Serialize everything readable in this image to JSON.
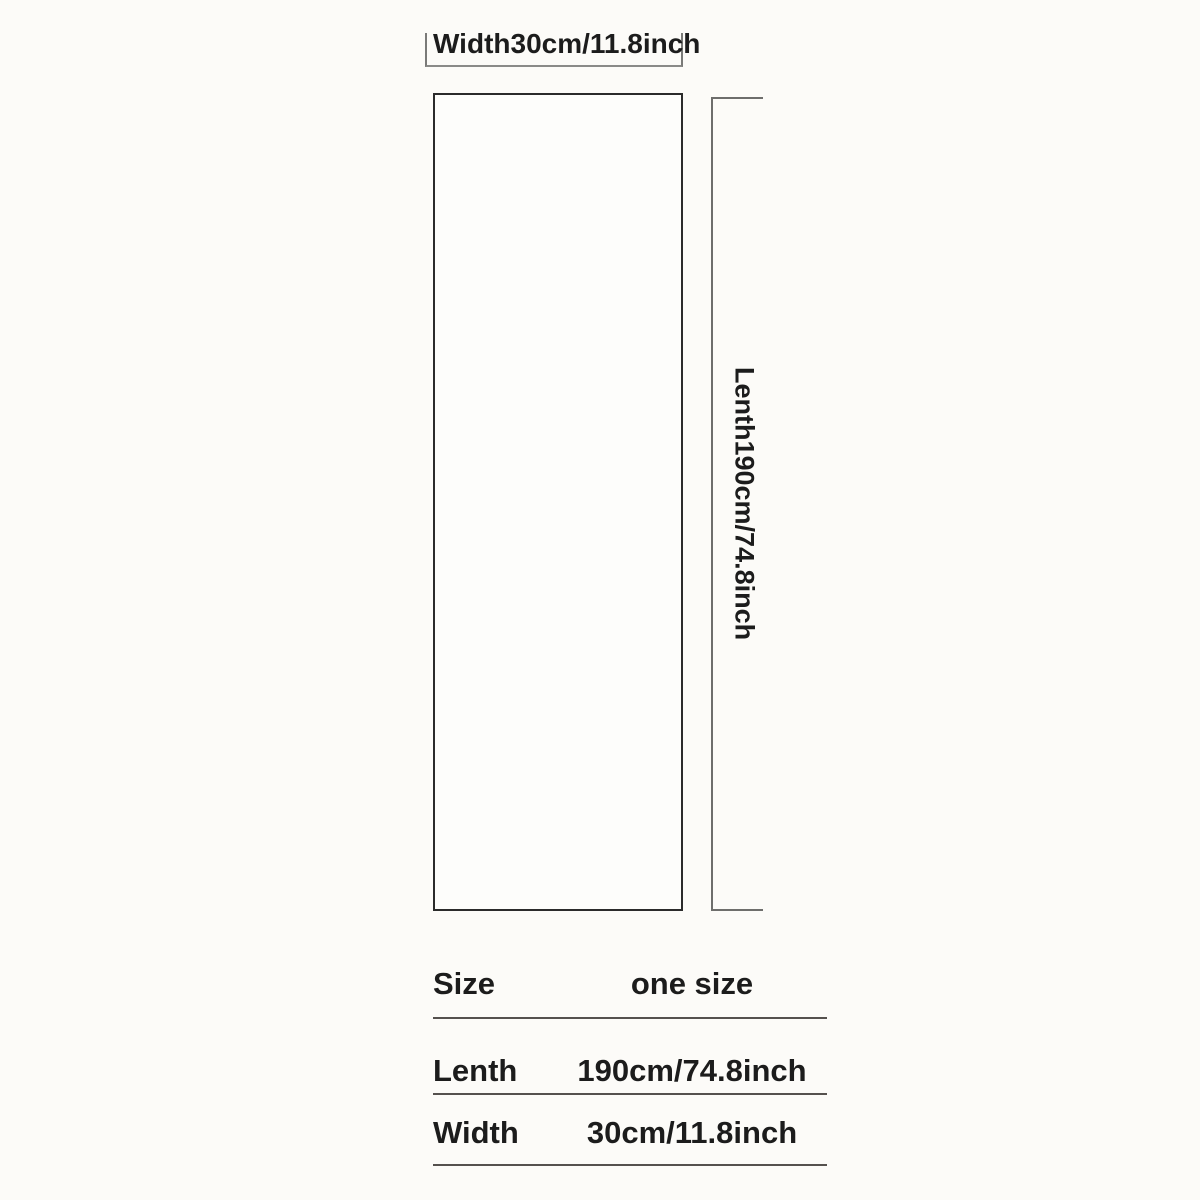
{
  "page": {
    "kind": "product-size-chart-image",
    "background_color": "#fcfbf8",
    "text_color": "#1c1c1c",
    "outline_color": "#2b2b2b",
    "dimension_line_color": "#6e6e6c"
  },
  "diagram": {
    "width_dimension_label": "Width30cm/11.8inch",
    "length_dimension_label": "Lenth190cm/74.8inch"
  },
  "size_table": {
    "rows": [
      {
        "label": "Size",
        "value": "one size"
      },
      {
        "label": "Lenth",
        "value": "190cm/74.8inch"
      },
      {
        "label": "Width",
        "value": "30cm/11.8inch"
      }
    ]
  }
}
